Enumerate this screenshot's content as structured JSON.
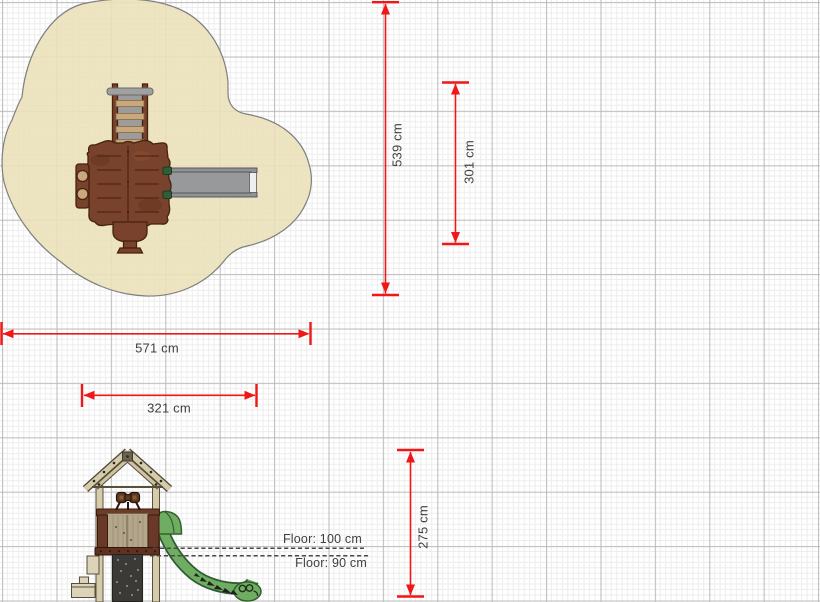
{
  "dims": {
    "zone_height": {
      "label": "539 cm"
    },
    "equip_height": {
      "label": "301 cm"
    },
    "zone_width": {
      "label": "571 cm"
    },
    "equip_width": {
      "label": "321 cm"
    },
    "tower_height": {
      "label": "275 cm"
    }
  },
  "floor_labels": {
    "upper": {
      "label": "Floor: 100 cm"
    },
    "lower": {
      "label": "Floor: 90 cm"
    }
  },
  "colors": {
    "dimension_red": "#f01717",
    "text_color": "#3f3f3f",
    "dash_gray": "#4a4a4a",
    "grid_major": "#b9b9b9",
    "grid_minor": "#ededed",
    "zone_fill": "#eae0b8",
    "zone_border": "#7f7f7f",
    "wood_brown": "#79422c",
    "wood_dark": "#46220f",
    "slide_gray": "#97999b",
    "beam_tan": "#d6cbab",
    "panel_tan": "#b3a68b",
    "rung_tan": "#c9a87c",
    "slide_green": "#6fae62",
    "slide_green_dark": "#33602f",
    "wall_dark": "#3b3a36"
  }
}
